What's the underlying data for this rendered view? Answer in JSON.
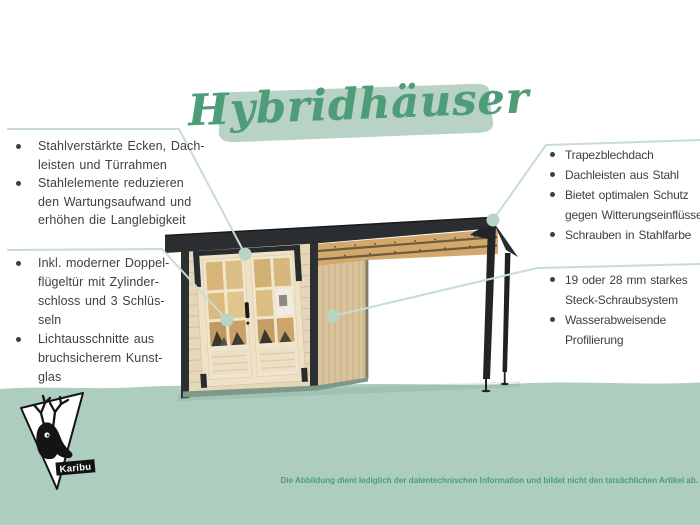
{
  "title": {
    "text": "Hybridhäuser"
  },
  "annotations": {
    "left_top": {
      "items": [
        {
          "text": "Stahlverstärkte Ecken, Dach-\nleisten und Türrahmen"
        },
        {
          "text": "Stahlelemente reduzieren\nden Wartungsaufwand und\nerhöhen die Langlebigkeit"
        }
      ]
    },
    "left_bottom": {
      "items": [
        {
          "text": "Inkl. moderner Doppel-\nflügeltür mit Zylinder-\nschloss und 3 Schlüs-\nseln"
        },
        {
          "text": "Lichtausschnitte aus\nbruchsicherem Kunst-\nglas"
        }
      ]
    },
    "right_top": {
      "items": [
        {
          "text": "Trapezblechdach"
        },
        {
          "text": "Dachleisten aus Stahl"
        },
        {
          "text": "Bietet optimalen Schutz\ngegen Witterungseinflüsse"
        },
        {
          "text": "Schrauben in Stahlfarbe"
        }
      ]
    },
    "right_bottom": {
      "items": [
        {
          "text": "19 oder 28 mm starkes\nSteck-Schraubsystem"
        },
        {
          "text": "Wasserabweisende\nProfilierung"
        }
      ]
    }
  },
  "logo": {
    "brand": "Karibu"
  },
  "footer": {
    "disclaimer": "Die Abbildung dient lediglich der datentechnischen Information und bildet nicht den tatsächlichen Artikel ab."
  },
  "colors": {
    "background": "#ffffff",
    "ground_mint": "#adcebf",
    "accent_green": "#4f9c79",
    "brush_green": "#b8d3c6",
    "callout_line": "#c6ded1",
    "callout_dot": "#b7d4c5",
    "text_ink": "#3f3f3d",
    "roof_dark": "#2b2e30",
    "wall_wood": "#e7d7ba",
    "wall_side_wood": "#d9c39c",
    "door_cream": "#f0e5cd",
    "glass_wood": "#dcba80",
    "beam_wood": "#d2a96b"
  }
}
